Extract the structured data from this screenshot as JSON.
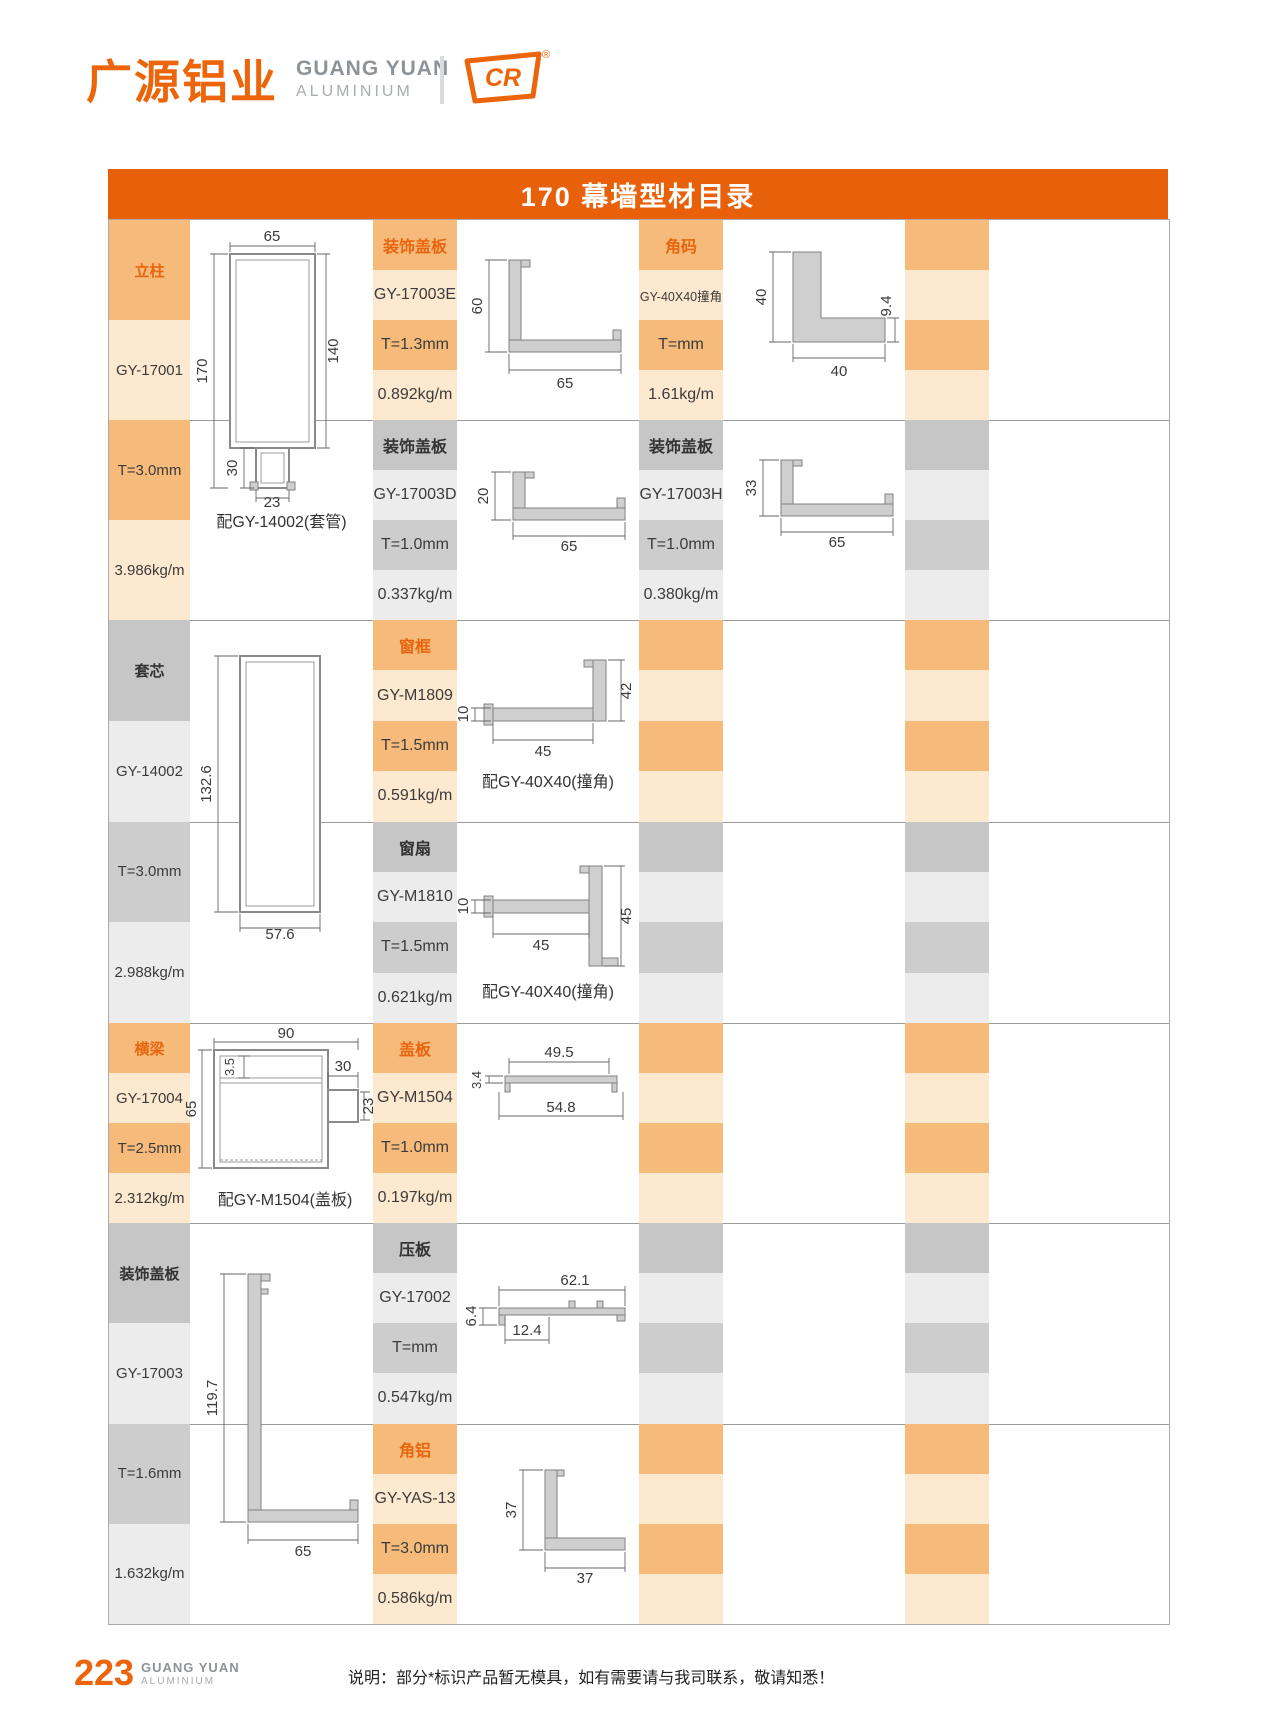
{
  "header": {
    "logo_cn": "广源铝业",
    "logo_en1": "GUANG YUAN",
    "logo_en2": "ALUMINIUM",
    "logo_mark": "CR",
    "logo_reg": "®"
  },
  "title": "170 幕墙型材目录",
  "footer": {
    "page": "223",
    "brand1": "GUANG YUAN",
    "brand2": "ALUMINIUM",
    "note": "说明：部分*标识产品暂无模具，如有需要请与我司联系，敬请知悉！"
  },
  "colors": {
    "brand_orange": "#E8610A",
    "cell_orange": "#F6BB7B",
    "cell_cream": "#FCE9CF",
    "cell_gray": "#C6C6C6",
    "cell_gray_light": "#ECECEC"
  },
  "blocks": {
    "s1a": {
      "header": "立柱",
      "code": "GY-17001",
      "thickness": "T=3.0mm",
      "weight": "3.986kg/m",
      "caption": "配GY-14002(套管)",
      "dims": {
        "w": "65",
        "h": "170",
        "h2": "140",
        "tail_h": "30",
        "tail_w": "23"
      }
    },
    "s1b1": {
      "header": "装饰盖板",
      "code": "GY-17003E",
      "thickness": "T=1.3mm",
      "weight": "0.892kg/m",
      "dims": {
        "h": "60",
        "w": "65"
      }
    },
    "s1c1": {
      "header": "角码",
      "code": "GY-40X40撞角",
      "thickness": "T=mm",
      "weight": "1.61kg/m",
      "dims": {
        "h": "40",
        "w": "40",
        "t": "9.4"
      }
    },
    "s1b2": {
      "header": "装饰盖板",
      "code": "GY-17003D",
      "thickness": "T=1.0mm",
      "weight": "0.337kg/m",
      "dims": {
        "h": "20",
        "w": "65"
      }
    },
    "s1c2": {
      "header": "装饰盖板",
      "code": "GY-17003H",
      "thickness": "T=1.0mm",
      "weight": "0.380kg/m",
      "dims": {
        "h": "33",
        "w": "65"
      }
    },
    "s2a": {
      "header": "套芯",
      "code": "GY-14002",
      "thickness": "T=3.0mm",
      "weight": "2.988kg/m",
      "dims": {
        "h": "132.6",
        "w": "57.6"
      }
    },
    "s2b1": {
      "header": "窗框",
      "code": "GY-M1809",
      "thickness": "T=1.5mm",
      "weight": "0.591kg/m",
      "caption": "配GY-40X40(撞角)",
      "dims": {
        "t": "10",
        "w": "45",
        "h": "42"
      }
    },
    "s2b2": {
      "header": "窗扇",
      "code": "GY-M1810",
      "thickness": "T=1.5mm",
      "weight": "0.621kg/m",
      "caption": "配GY-40X40(撞角)",
      "dims": {
        "t": "10",
        "w": "45",
        "h": "45"
      }
    },
    "s3a": {
      "header": "横梁",
      "code": "GY-17004",
      "thickness": "T=2.5mm",
      "weight": "2.312kg/m",
      "caption": "配GY-M1504(盖板)",
      "dims": {
        "w": "90",
        "t": "3.5",
        "ext_w": "30",
        "h": "65",
        "ext_h": "23"
      }
    },
    "s3b": {
      "header": "盖板",
      "code": "GY-M1504",
      "thickness": "T=1.0mm",
      "weight": "0.197kg/m",
      "dims": {
        "t": "3.4",
        "w1": "49.5",
        "w2": "54.8"
      }
    },
    "s4a": {
      "header": "装饰盖板",
      "code": "GY-17003",
      "thickness": "T=1.6mm",
      "weight": "1.632kg/m",
      "dims": {
        "h": "119.7",
        "w": "65"
      }
    },
    "s4b1": {
      "header": "压板",
      "code": "GY-17002",
      "thickness": "T=mm",
      "weight": "0.547kg/m",
      "dims": {
        "w": "62.1",
        "w2": "12.4",
        "t": "6.4"
      }
    },
    "s4b2": {
      "header": "角铝",
      "code": "GY-YAS-13",
      "thickness": "T=3.0mm",
      "weight": "0.586kg/m",
      "dims": {
        "h": "37",
        "w": "37"
      }
    }
  }
}
